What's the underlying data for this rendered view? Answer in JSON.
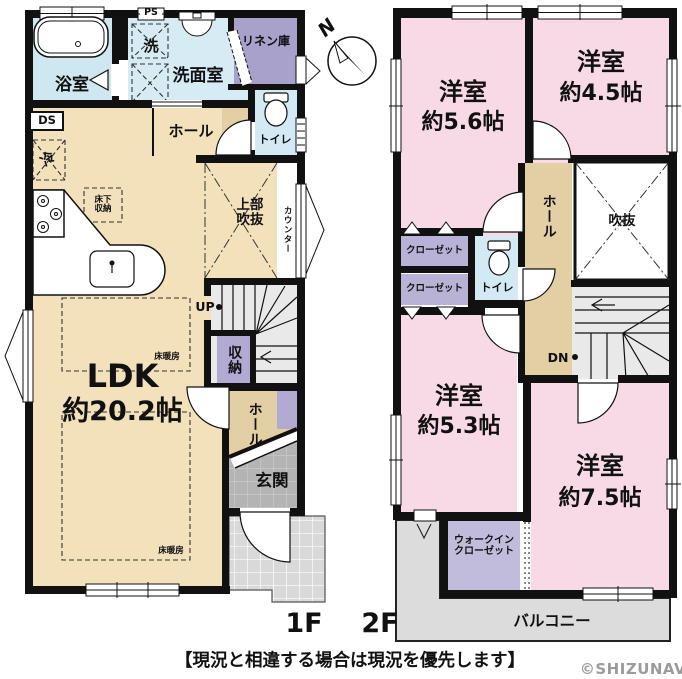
{
  "floor1": {
    "floor_label": "1F",
    "rooms": {
      "bath": "浴室",
      "ps": "PS",
      "wash": "洗",
      "washroom": "洗面室",
      "linen": "リネン庫",
      "toilet": "トイレ",
      "hall_upper": "ホール",
      "ds": "DS",
      "fridge": "冷",
      "underfloor_storage": "床下\n収納",
      "upper_void": "上部\n吹抜",
      "counter": "カウンター",
      "up": "UP",
      "storage": "収納",
      "ldk_name": "LDK",
      "ldk_size": "約20.2帖",
      "floor_heating_1": "床暖房",
      "floor_heating_2": "床暖房",
      "hall_lower": "ホール",
      "entrance": "玄関"
    }
  },
  "floor2": {
    "floor_label": "2F",
    "rooms": {
      "room56_name": "洋室",
      "room56_size": "約5.6帖",
      "room45_name": "洋室",
      "room45_size": "約4.5帖",
      "closet1": "クローゼット",
      "closet2": "クローゼット",
      "toilet": "トイレ",
      "hall": "ホール",
      "void": "吹抜",
      "dn": "DN",
      "room53_name": "洋室",
      "room53_size": "約5.3帖",
      "room75_name": "洋室",
      "room75_size": "約7.5帖",
      "wic": "ウォークイン\nクローゼット",
      "balcony": "バルコニー"
    }
  },
  "compass": {
    "north_label": "N"
  },
  "footer": {
    "caption": "【現況と相違する場合は現況を優先します】",
    "watermark": "©SHIZUNAV"
  },
  "colors": {
    "wall": "#111111",
    "ldk_tan": "#f3e1bc",
    "hall_tan": "#e3cfa4",
    "room_pink": "#f8dae6",
    "water_blue": "#d7ebf4",
    "closet_purple": "#b8b2d7",
    "linen_purple": "#a7a1cb",
    "stairs_gray": "#e9e9e9",
    "balcony_gray": "#dcdcdc",
    "entrance_gray": "#b4b4b4"
  }
}
